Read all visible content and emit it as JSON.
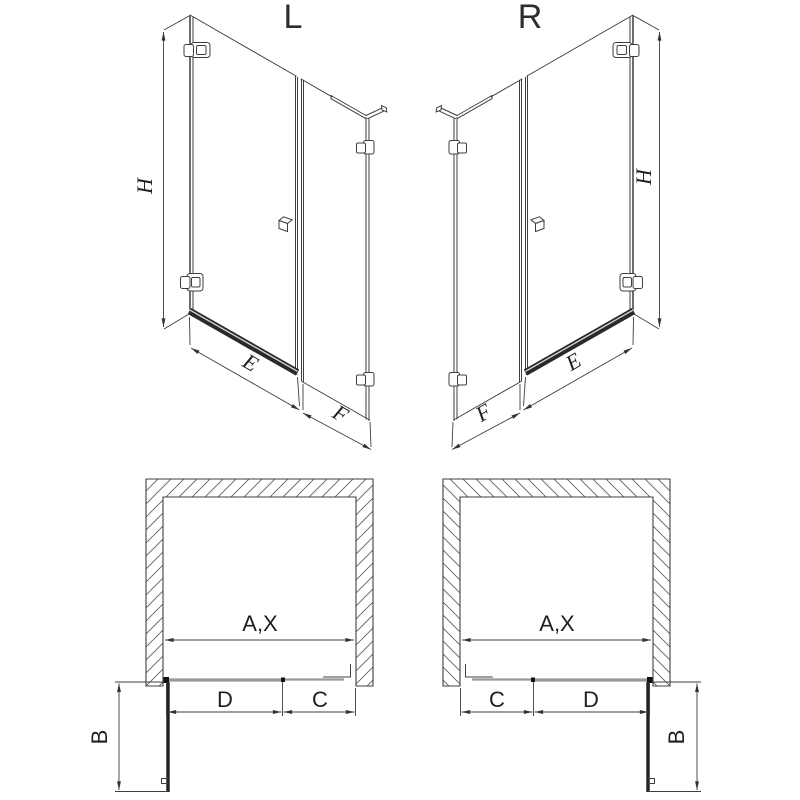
{
  "page": {
    "background": "#ffffff",
    "description": "Technical line drawing of a walk-in shower enclosure (hinged door + fixed inline panel) in left (L) and right (R) hand versions; top row: isometric elevations, bottom row: plan views with door swing."
  },
  "colors": {
    "line": "#3f3f3f",
    "threshold_rail": "#2a2a2a",
    "threshold_highlight": "#d8d8d8",
    "glass_plan": "#999999",
    "open_door": "#222222",
    "node": "#111111",
    "hatch": "#5a5a5a"
  },
  "labels": {
    "variant_left": "L",
    "variant_right": "R",
    "height": "H",
    "door_width": "E",
    "panel_width": "F",
    "opening_width": "A,X",
    "door_segment": "D",
    "panel_segment": "C",
    "door_projection": "B"
  },
  "views": {
    "elevation_left": {
      "variant": "L",
      "dimensions": [
        "H",
        "E",
        "F"
      ]
    },
    "elevation_right": {
      "variant": "R",
      "dimensions": [
        "H",
        "E",
        "F"
      ]
    },
    "plan_left": {
      "dimensions": [
        "A,X",
        "D",
        "C",
        "B"
      ]
    },
    "plan_right": {
      "dimensions": [
        "A,X",
        "C",
        "D",
        "B"
      ]
    }
  }
}
